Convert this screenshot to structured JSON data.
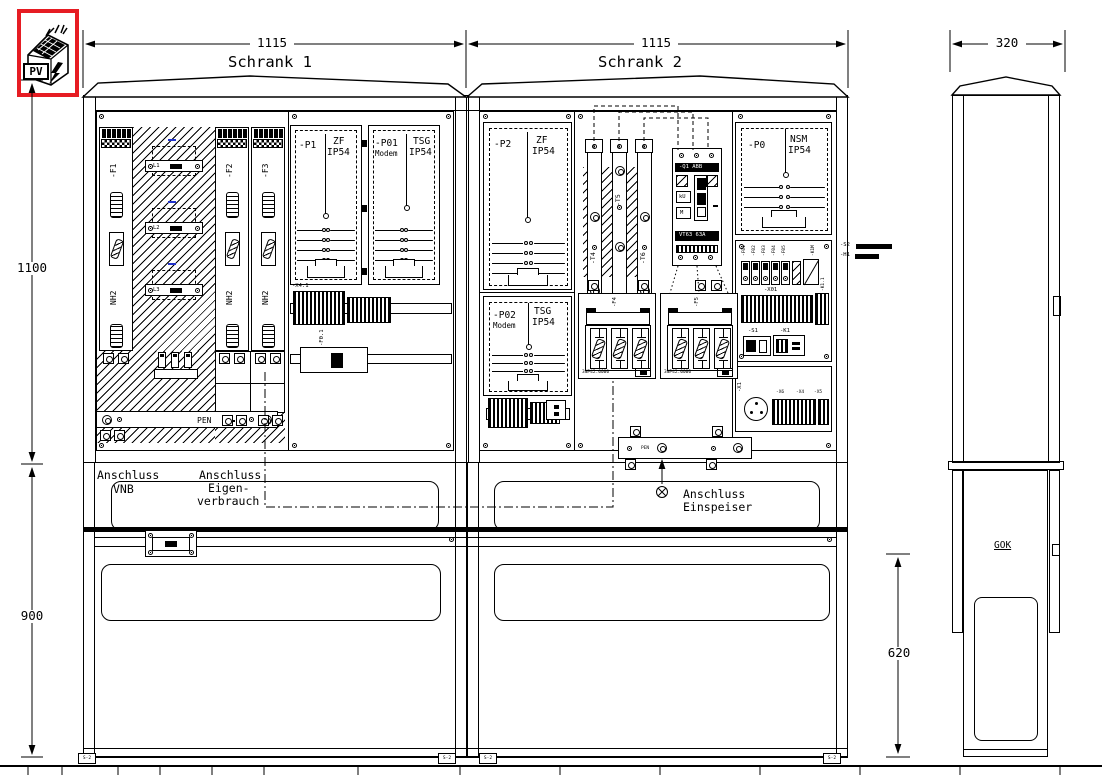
{
  "colors": {
    "line": "#000000",
    "bg": "#ffffff",
    "logo_red": "#e61c23",
    "phase_blue": "#2233cc"
  },
  "logo": {
    "label": "PV"
  },
  "dims": {
    "schrank1_width": "1115",
    "schrank2_width": "1115",
    "side_width": "320",
    "upper_height": "1100",
    "base_height": "900",
    "side_base_height": "620"
  },
  "titles": {
    "schrank1": "Schrank 1",
    "schrank2": "Schrank 2"
  },
  "schrank1": {
    "fuses": [
      {
        "id": "-F1",
        "size": "NH2"
      },
      {
        "id": "-F2",
        "size": "NH2"
      },
      {
        "id": "-F3",
        "size": "NH2"
      }
    ],
    "phases": [
      "L1",
      "L2",
      "L3"
    ],
    "pen_label": "PEN",
    "meter1": {
      "id": "-P1",
      "type": "ZF",
      "ip": "IP54"
    },
    "meter2": {
      "id": "-P01",
      "modem": "Modem",
      "type": "TSG",
      "ip": "IP54"
    },
    "terminal_block": "-X4.1",
    "fuse_holder": "-F0.1"
  },
  "schrank2": {
    "meter1": {
      "id": "-P2",
      "type": "ZF",
      "ip": "IP54"
    },
    "meter2": {
      "id": "-P02",
      "modem": "Modem",
      "type": "TSG",
      "ip": "IP54"
    },
    "meter3": {
      "id": "-P0",
      "type": "NSM",
      "ip": "IP54"
    },
    "cts": [
      "-T4",
      "-T5",
      "-T6"
    ],
    "breaker": {
      "id": "-Q1",
      "brand": "ABB",
      "aux1": "kU",
      "aux2": "M",
      "rating": "VT63 63A"
    },
    "nh_switches": [
      {
        "id": "-F4",
        "part": "3NP42.0000"
      },
      {
        "id": "-F5",
        "part": "3NP42.0000"
      }
    ],
    "mcb_labels": [
      "-F01",
      "-F02",
      "-F03",
      "-F04",
      "-F05"
    ],
    "contactor": "-K1M",
    "terminal_strip": "-X01",
    "relay": "-K1.1",
    "switch": "-S1",
    "k1": "-K1",
    "x1": "-X1",
    "x6": "-X6",
    "x4": "-X4",
    "x5": "-X5",
    "pen_label": "PEN",
    "annotation1": "-S2",
    "annotation2": "-H1"
  },
  "connections": {
    "vnb_line1": "Anschluss",
    "vnb_line2": "VNB",
    "eigen_line1": "Anschluss",
    "eigen_line2": "Eigen-",
    "eigen_line3": "verbrauch",
    "einspeiser_line1": "Anschluss",
    "einspeiser_line2": "Einspeiser"
  },
  "side_view": {
    "gok": "GOK"
  },
  "feet": [
    "S-2",
    "S-2",
    "S-2",
    "S-2"
  ]
}
